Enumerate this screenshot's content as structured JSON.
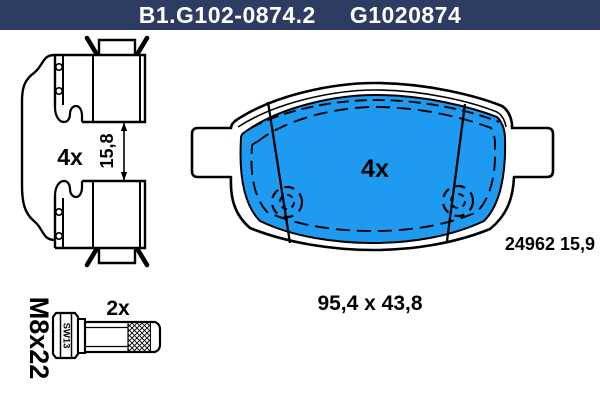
{
  "header": {
    "part_code": "B1.G102-0874.2",
    "oem_code": "G1020874",
    "bg_color": "#2e3c63",
    "text_color": "#ffffff"
  },
  "colors": {
    "pad_friction_blue": "#1e9bf0",
    "line_black": "#000000",
    "background_white": "#ffffff"
  },
  "side_view": {
    "quantity": "4x",
    "thickness": "15,8"
  },
  "pad_front_view": {
    "quantity": "4x",
    "wva_code": "24962 15,9"
  },
  "pad_dimensions": "95,4 x 43,8",
  "bolt": {
    "quantity": "2x",
    "thread_size": "M8x22",
    "wrench_size": "SW13"
  }
}
